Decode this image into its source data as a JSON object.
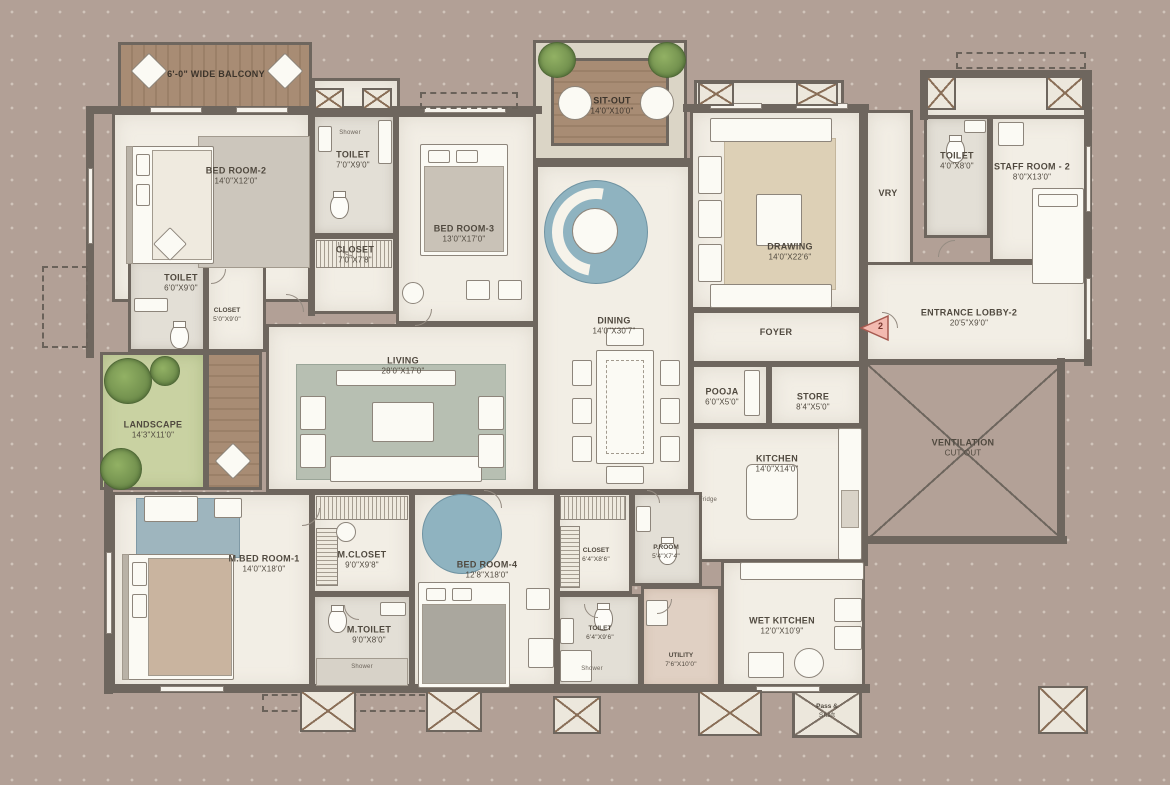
{
  "plan": {
    "marker": {
      "number": "2"
    },
    "colors": {
      "background": "#b2a096",
      "wall": "#6e665e",
      "floor_cream": "#f2eee5",
      "deck_brown": "#a88c74",
      "landscape_green": "#c9d2a2",
      "marker_fill": "#f3bab0"
    },
    "rooms": [
      {
        "id": "balcony",
        "label": "6'-0\" WIDE BALCONY",
        "dim": "",
        "floor": "deckh",
        "x": 118,
        "y": 42,
        "w": 194,
        "h": 70,
        "lx": 216,
        "ly": 74,
        "cls": "ondeck"
      },
      {
        "id": "bed-room-2",
        "label": "BED ROOM-2",
        "dim": "14'0\"X12'0\"",
        "floor": "cream",
        "x": 112,
        "y": 112,
        "w": 200,
        "h": 190,
        "lx": 236,
        "ly": 176
      },
      {
        "id": "toilet-2-vent",
        "label": "",
        "dim": "",
        "floor": "cream",
        "x": 312,
        "y": 78,
        "w": 88,
        "h": 38
      },
      {
        "id": "toilet-2",
        "label": "TOILET",
        "dim": "7'0\"X9'0\"",
        "floor": "gray",
        "x": 312,
        "y": 114,
        "w": 84,
        "h": 122,
        "lx": 353,
        "ly": 160
      },
      {
        "id": "closet-2",
        "label": "CLOSET",
        "dim": "7'0\"X7'8\"",
        "floor": "cream",
        "x": 312,
        "y": 236,
        "w": 84,
        "h": 78,
        "lx": 355,
        "ly": 255
      },
      {
        "id": "bed-room-3",
        "label": "BED ROOM-3",
        "dim": "13'0\"X17'0\"",
        "floor": "cream",
        "x": 396,
        "y": 114,
        "w": 140,
        "h": 210,
        "lx": 464,
        "ly": 234
      },
      {
        "id": "sit-out-frame",
        "label": "",
        "dim": "",
        "floor": "stone",
        "x": 533,
        "y": 40,
        "w": 154,
        "h": 124
      },
      {
        "id": "sit-out",
        "label": "SIT-OUT",
        "dim": "14'0\"X10'0\"",
        "floor": "deckv",
        "x": 551,
        "y": 58,
        "w": 118,
        "h": 88,
        "lx": 612,
        "ly": 106,
        "cls": "ondeck"
      },
      {
        "id": "dining",
        "label": "DINING",
        "dim": "14'0\"X30'7\"",
        "floor": "cream",
        "x": 535,
        "y": 164,
        "w": 156,
        "h": 328,
        "lx": 614,
        "ly": 326
      },
      {
        "id": "drawing-top",
        "label": "",
        "dim": "",
        "floor": "cream",
        "x": 694,
        "y": 80,
        "w": 150,
        "h": 32
      },
      {
        "id": "drawing",
        "label": "DRAWING",
        "dim": "14'0\"X22'6\"",
        "floor": "cream",
        "x": 690,
        "y": 110,
        "w": 175,
        "h": 200,
        "lx": 790,
        "ly": 252
      },
      {
        "id": "vry",
        "label": "VRY",
        "dim": "",
        "floor": "cream",
        "x": 865,
        "y": 110,
        "w": 48,
        "h": 192,
        "lx": 888,
        "ly": 193
      },
      {
        "id": "staff-top",
        "label": "",
        "dim": "",
        "floor": "cream",
        "x": 922,
        "y": 74,
        "w": 168,
        "h": 44
      },
      {
        "id": "staff-toilet",
        "label": "TOILET",
        "dim": "4'0\"X8'0\"",
        "floor": "gray",
        "x": 924,
        "y": 116,
        "w": 66,
        "h": 122,
        "lx": 957,
        "ly": 161
      },
      {
        "id": "staff-room-2",
        "label": "STAFF ROOM - 2",
        "dim": "8'0\"X13'0\"",
        "floor": "cream",
        "x": 990,
        "y": 116,
        "w": 100,
        "h": 146,
        "lx": 1032,
        "ly": 172
      },
      {
        "id": "entrance-lobby",
        "label": "ENTRANCE LOBBY-2",
        "dim": "20'5\"X9'0\"",
        "floor": "cream",
        "x": 865,
        "y": 262,
        "w": 225,
        "h": 100,
        "lx": 969,
        "ly": 318
      },
      {
        "id": "toilet-left",
        "label": "TOILET",
        "dim": "6'0\"X9'0\"",
        "floor": "gray",
        "x": 128,
        "y": 258,
        "w": 78,
        "h": 94,
        "lx": 181,
        "ly": 283
      },
      {
        "id": "closet-left",
        "label": "CLOSET",
        "dim": "5'0\"X9'0\"",
        "floor": "cream",
        "x": 206,
        "y": 258,
        "w": 60,
        "h": 94,
        "lx": 227,
        "ly": 316,
        "cls": "small"
      },
      {
        "id": "landscape",
        "label": "LANDSCAPE",
        "dim": "14'3\"X11'0\"",
        "floor": "green",
        "x": 100,
        "y": 352,
        "w": 106,
        "h": 138,
        "lx": 153,
        "ly": 430
      },
      {
        "id": "landscape-deck",
        "label": "",
        "dim": "",
        "floor": "deckv",
        "x": 206,
        "y": 352,
        "w": 56,
        "h": 138
      },
      {
        "id": "living",
        "label": "LIVING",
        "dim": "28'0\"X17'0\"",
        "floor": "cream",
        "x": 266,
        "y": 324,
        "w": 270,
        "h": 168,
        "lx": 403,
        "ly": 366
      },
      {
        "id": "foyer",
        "label": "FOYER",
        "dim": "",
        "floor": "cream",
        "x": 691,
        "y": 310,
        "w": 174,
        "h": 54,
        "lx": 776,
        "ly": 332
      },
      {
        "id": "pooja",
        "label": "POOJA",
        "dim": "6'0\"X5'0\"",
        "floor": "cream",
        "x": 691,
        "y": 364,
        "w": 78,
        "h": 62,
        "lx": 722,
        "ly": 397
      },
      {
        "id": "store",
        "label": "STORE",
        "dim": "8'4\"X5'0\"",
        "floor": "cream",
        "x": 769,
        "y": 364,
        "w": 96,
        "h": 62,
        "lx": 813,
        "ly": 402
      },
      {
        "id": "kitchen",
        "label": "KITCHEN",
        "dim": "14'0\"X14'0\"",
        "floor": "cream",
        "x": 691,
        "y": 426,
        "w": 174,
        "h": 136,
        "lx": 777,
        "ly": 464
      },
      {
        "id": "ventilation",
        "label": "VENTILATION",
        "dim": "CUT OUT",
        "floor": "mauvex",
        "x": 865,
        "y": 362,
        "w": 200,
        "h": 180,
        "lx": 963,
        "ly": 448
      },
      {
        "id": "m-bed-room-1",
        "label": "M.BED ROOM-1",
        "dim": "14'0\"X18'0\"",
        "floor": "cream",
        "x": 112,
        "y": 492,
        "w": 200,
        "h": 198,
        "lx": 264,
        "ly": 564
      },
      {
        "id": "m-closet",
        "label": "M.CLOSET",
        "dim": "9'0\"X9'8\"",
        "floor": "cream",
        "x": 312,
        "y": 492,
        "w": 100,
        "h": 102,
        "lx": 362,
        "ly": 560
      },
      {
        "id": "m-toilet",
        "label": "M.TOILET",
        "dim": "9'0\"X8'0\"",
        "floor": "gray",
        "x": 312,
        "y": 594,
        "w": 100,
        "h": 96,
        "lx": 369,
        "ly": 635
      },
      {
        "id": "bed-room-4",
        "label": "BED ROOM-4",
        "dim": "12'8\"X18'0\"",
        "floor": "cream",
        "x": 412,
        "y": 492,
        "w": 145,
        "h": 198,
        "lx": 487,
        "ly": 570
      },
      {
        "id": "closet-4",
        "label": "CLOSET",
        "dim": "6'4\"X8'6\"",
        "floor": "cream",
        "x": 557,
        "y": 492,
        "w": 75,
        "h": 102,
        "lx": 596,
        "ly": 556,
        "cls": "small"
      },
      {
        "id": "p-room",
        "label": "P.ROOM",
        "dim": "5'4\"X7'4\"",
        "floor": "gray",
        "x": 632,
        "y": 492,
        "w": 70,
        "h": 94,
        "lx": 666,
        "ly": 553,
        "cls": "small"
      },
      {
        "id": "toilet-bottom",
        "label": "TOILET",
        "dim": "6'4\"X9'6\"",
        "floor": "gray",
        "x": 557,
        "y": 594,
        "w": 84,
        "h": 96,
        "lx": 600,
        "ly": 634,
        "cls": "small"
      },
      {
        "id": "utility",
        "label": "UTILITY",
        "dim": "7'6\"X10'0\"",
        "floor": "pink",
        "x": 641,
        "y": 586,
        "w": 80,
        "h": 104,
        "lx": 681,
        "ly": 661,
        "cls": "small"
      },
      {
        "id": "wet-kitchen",
        "label": "WET KITCHEN",
        "dim": "12'0\"X10'9\"",
        "floor": "cream",
        "x": 721,
        "y": 560,
        "w": 144,
        "h": 130,
        "lx": 782,
        "ly": 626
      },
      {
        "id": "pass-shaft",
        "label": "Pass &",
        "dim": "Shaft",
        "floor": "creamx",
        "x": 792,
        "y": 690,
        "w": 70,
        "h": 48,
        "lx": 827,
        "ly": 712,
        "cls": "small"
      }
    ],
    "mini_labels": [
      {
        "text": "Shower",
        "x": 350,
        "y": 133
      },
      {
        "text": "Shower",
        "x": 362,
        "y": 667
      },
      {
        "text": "Shower",
        "x": 592,
        "y": 669
      },
      {
        "text": "Fridge",
        "x": 708,
        "y": 500
      }
    ]
  }
}
